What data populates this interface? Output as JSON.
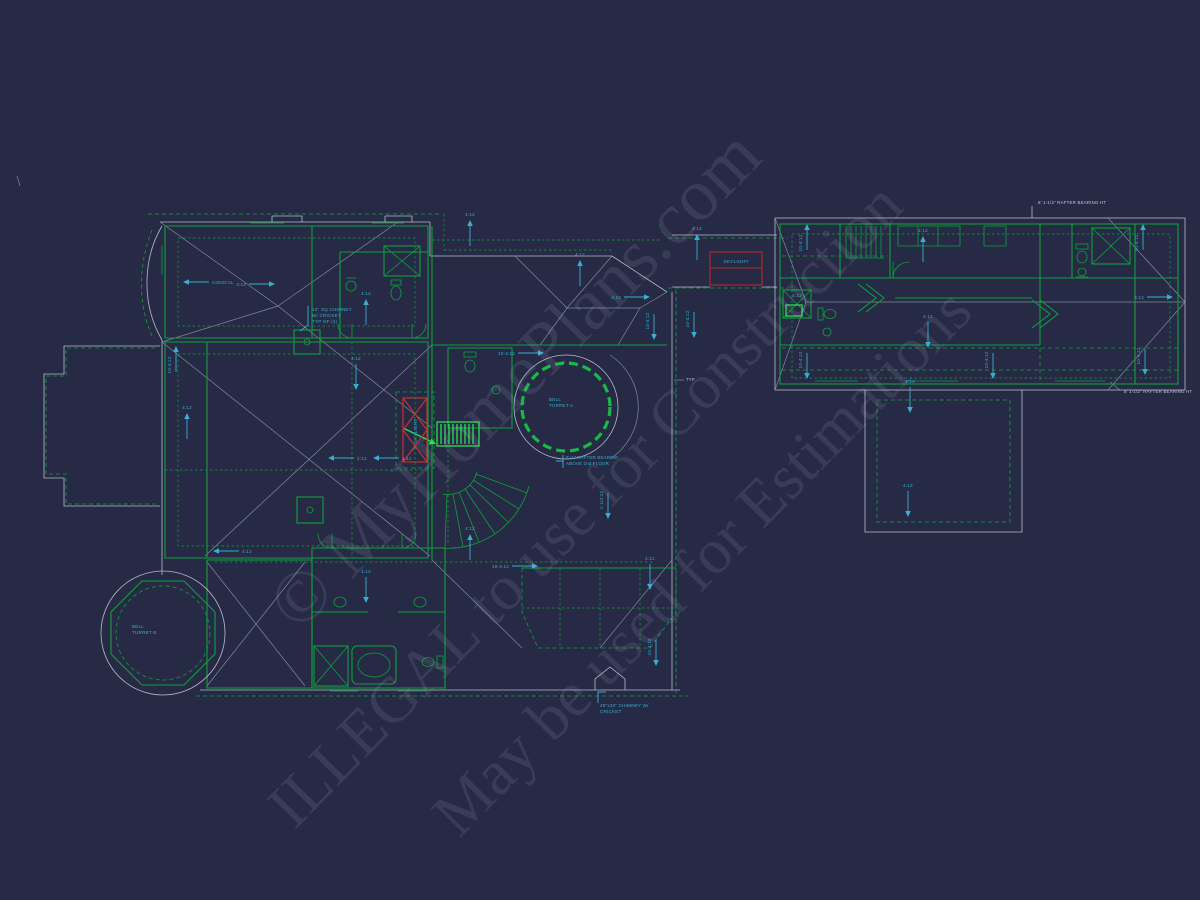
{
  "colors": {
    "background": "#262a45",
    "wall_green": "#0f9f3e",
    "bright_green": "#2fdd57",
    "roof_white": "#c3c7d6",
    "roof_dim": "#8d92a8",
    "cyan": "#3aaed0",
    "red": "#b3282e",
    "watermark": "rgba(182,188,212,0.13)"
  },
  "watermarks": [
    {
      "text": "© MyHomePlans.com",
      "x": 515,
      "y": 380,
      "size": 74
    },
    {
      "text": "ILLEGAL to use for Construction",
      "x": 585,
      "y": 505,
      "size": 64
    },
    {
      "text": "May be used for Estimations",
      "x": 702,
      "y": 562,
      "size": 64
    }
  ],
  "labels": [
    {
      "id": "chimney-callout-label",
      "lines": [
        "12\" SQ CHIMNEY",
        "W/ CRICKET",
        "TYP OF (2)"
      ],
      "x": 312,
      "y": 311,
      "color": "cyan",
      "size": 4.6,
      "anchor": "start"
    },
    {
      "id": "bell-turret-a-label",
      "lines": [
        "BELL",
        "TURRET A"
      ],
      "x": 549,
      "y": 401,
      "color": "cyan",
      "size": 4.6,
      "anchor": "start"
    },
    {
      "id": "bell-turret-b-label",
      "lines": [
        "BELL",
        "TURRET B"
      ],
      "x": 132,
      "y": 628,
      "color": "cyan",
      "size": 4.6,
      "anchor": "start"
    },
    {
      "id": "skylight-vertical-label",
      "lines": [
        "SKYLIGHT"
      ],
      "x": 417,
      "y": 431,
      "color": "cyan",
      "size": 4.6,
      "anchor": "middle",
      "rotate": -90
    },
    {
      "id": "skylight-box-label",
      "lines": [
        "SKYLIGHT"
      ],
      "x": 736,
      "y": 263,
      "color": "cyan",
      "size": 4.8,
      "anchor": "middle"
    },
    {
      "id": "rafter-bearing-above-label",
      "lines": [
        "9'-1\" RAFTER BEARING",
        "ABOVE 2nd FLOOR"
      ],
      "x": 566,
      "y": 459,
      "color": "cyan",
      "size": 4.4,
      "anchor": "start"
    },
    {
      "id": "rafter-height-top-label",
      "lines": [
        "8' 1-1/2\" RAFTER BEARING HT"
      ],
      "x": 1038,
      "y": 204,
      "color": "white",
      "size": 4.4,
      "anchor": "start"
    },
    {
      "id": "rafter-height-bottom-label",
      "lines": [
        "8' 1-1/2\" RAFTER BEARING HT"
      ],
      "x": 1124,
      "y": 393,
      "color": "white",
      "size": 4.4,
      "anchor": "start"
    },
    {
      "id": "chimney-cricket-label",
      "lines": [
        "48\"x32\" CHIMNEY W/",
        "CRICKET"
      ],
      "x": 600,
      "y": 707,
      "color": "cyan",
      "size": 4.6,
      "anchor": "start"
    },
    {
      "id": "typ-label",
      "lines": [
        "TYP"
      ],
      "x": 686,
      "y": 381,
      "color": "white",
      "size": 4.2,
      "anchor": "start"
    }
  ],
  "slopes": [
    {
      "x": 200,
      "y": 282,
      "dir": "left",
      "label": "CONICAL"
    },
    {
      "x": 258,
      "y": 284,
      "dir": "right",
      "label": "4:12"
    },
    {
      "x": 176,
      "y": 363,
      "dir": "up",
      "label": "10-4:12",
      "vertical": true
    },
    {
      "x": 187,
      "y": 430,
      "dir": "up",
      "label": "4:12"
    },
    {
      "x": 356,
      "y": 373,
      "dir": "down",
      "label": "4:12"
    },
    {
      "x": 366,
      "y": 316,
      "dir": "up",
      "label": "4:12"
    },
    {
      "x": 470,
      "y": 237,
      "dir": "up",
      "label": "4:12"
    },
    {
      "x": 580,
      "y": 277,
      "dir": "up",
      "label": "4:12"
    },
    {
      "x": 633,
      "y": 297,
      "dir": "right",
      "label": "4:12"
    },
    {
      "x": 654,
      "y": 323,
      "dir": "down",
      "label": "10-4:12",
      "vertical": true
    },
    {
      "x": 527,
      "y": 353,
      "dir": "right",
      "label": "10-4:12"
    },
    {
      "x": 345,
      "y": 458,
      "dir": "left",
      "label": "2:12"
    },
    {
      "x": 390,
      "y": 458,
      "dir": "left",
      "label": "1:12"
    },
    {
      "x": 230,
      "y": 551,
      "dir": "left",
      "label": "4:12"
    },
    {
      "x": 470,
      "y": 551,
      "dir": "up",
      "label": "4:12"
    },
    {
      "x": 521,
      "y": 566,
      "dir": "right",
      "label": "10-4:12"
    },
    {
      "x": 608,
      "y": 502,
      "dir": "down",
      "label": "1-1/2:12",
      "vertical": true
    },
    {
      "x": 366,
      "y": 586,
      "dir": "down",
      "label": "4:12"
    },
    {
      "x": 650,
      "y": 573,
      "dir": "down",
      "label": "4:12"
    },
    {
      "x": 656,
      "y": 649,
      "dir": "down",
      "label": "10-4:12",
      "vertical": true
    },
    {
      "x": 697,
      "y": 251,
      "dir": "up",
      "label": "4:12"
    },
    {
      "x": 694,
      "y": 321,
      "dir": "down",
      "label": "10-4:12",
      "vertical": true
    },
    {
      "x": 807,
      "y": 241,
      "dir": "up",
      "label": "10-4:12",
      "vertical": true
    },
    {
      "x": 923,
      "y": 253,
      "dir": "up",
      "label": "4:12"
    },
    {
      "x": 1143,
      "y": 241,
      "dir": "up",
      "label": "10-4:12",
      "vertical": true
    },
    {
      "x": 1156,
      "y": 297,
      "dir": "right",
      "label": "4:12"
    },
    {
      "x": 797,
      "y": 297,
      "dir": "none",
      "label": "4:12"
    },
    {
      "x": 928,
      "y": 331,
      "dir": "down",
      "label": "4:12"
    },
    {
      "x": 807,
      "y": 362,
      "dir": "down",
      "label": "10-4:12",
      "vertical": true
    },
    {
      "x": 993,
      "y": 362,
      "dir": "down",
      "label": "10-4:12",
      "vertical": true
    },
    {
      "x": 1145,
      "y": 358,
      "dir": "down",
      "label": "10-4:12",
      "vertical": true
    },
    {
      "x": 910,
      "y": 396,
      "dir": "down",
      "label": "4:12"
    },
    {
      "x": 908,
      "y": 500,
      "dir": "down",
      "label": "4:12"
    }
  ]
}
